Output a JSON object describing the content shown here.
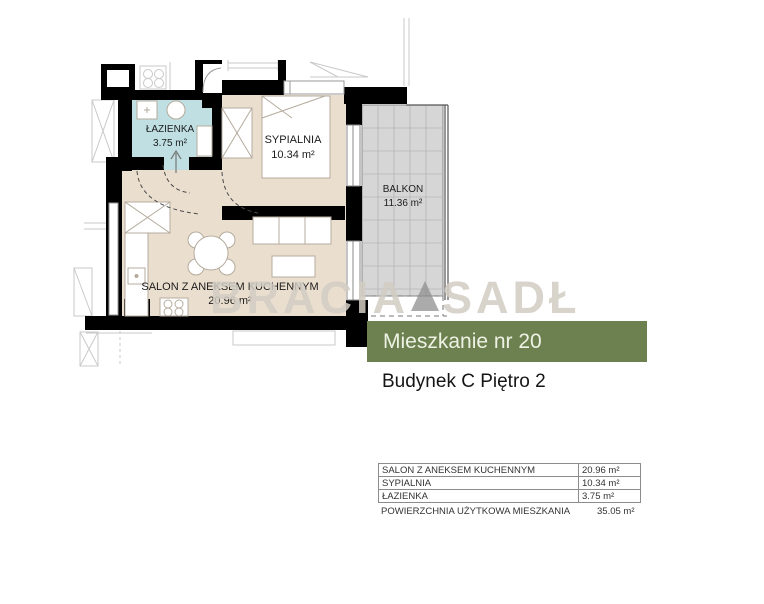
{
  "plan": {
    "rooms": {
      "lazienka": {
        "label": "ŁAZIENKA",
        "area": "3.75 m²"
      },
      "sypialnia": {
        "label": "SYPIALNIA",
        "area": "10.34 m²"
      },
      "salon": {
        "label": "SALON Z ANEKSEM KUCHENNYM",
        "area": "20.96 m²"
      },
      "balkon": {
        "label": "BALKON",
        "area": "11.36 m²"
      }
    },
    "watermark": {
      "part1": "BRACIA",
      "part2": "SADŁ",
      "glyph": "triangle-logo"
    }
  },
  "title": {
    "heading": "Mieszkanie nr 20",
    "subheading": "Budynek C Piętro 2"
  },
  "table": {
    "rows": [
      {
        "label": "SALON Z ANEKSEM KUCHENNYM",
        "value": "20.96 m²"
      },
      {
        "label": "SYPIALNIA",
        "value": "10.34 m²"
      },
      {
        "label": "ŁAZIENKA",
        "value": "3.75 m²"
      }
    ],
    "summary": {
      "label": "POWIERZCHNIA UŻYTKOWA MIESZKANIA",
      "value": "35.05 m²"
    }
  },
  "colors": {
    "floor_beige": "#eadfce",
    "bathroom_blue": "#bfdfe2",
    "balcony_gray": "#d6d6d6",
    "wall_black": "#000000",
    "accent_green": "#6d8050",
    "watermark_gray": "#d2cdc4"
  }
}
